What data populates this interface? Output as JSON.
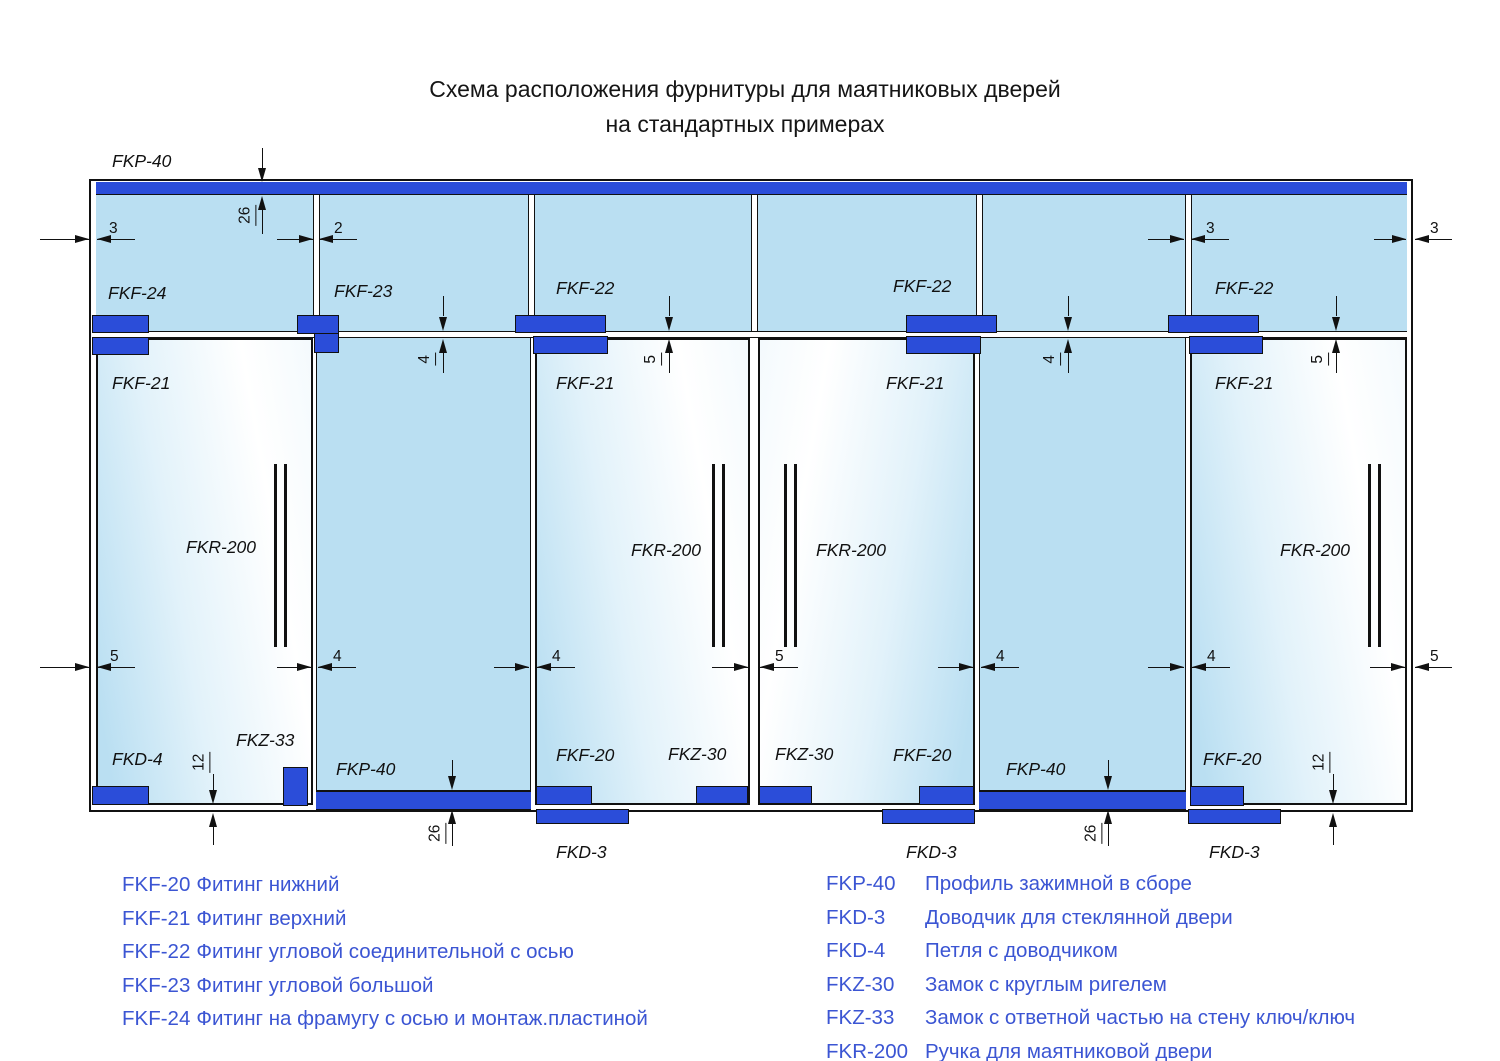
{
  "title": {
    "line1": "Схема расположения фурнитуры для маятниковых дверей",
    "line2": "на стандартных примерах"
  },
  "labels": {
    "fkp40": "FKP-40",
    "fkf24": "FKF-24",
    "fkf23": "FKF-23",
    "fkf22": "FKF-22",
    "fkf21": "FKF-21",
    "fkf20": "FKF-20",
    "fkr200": "FKR-200",
    "fkd4": "FKD-4",
    "fkd3": "FKD-3",
    "fkz33": "FKZ-33",
    "fkz30": "FKZ-30"
  },
  "dims": {
    "d2": "2",
    "d3": "3",
    "d4": "4",
    "d5": "5",
    "d12": "12",
    "d26": "26"
  },
  "legend": {
    "left": [
      {
        "code": "FKF-20",
        "desc": "Фитинг нижний"
      },
      {
        "code": "FKF-21",
        "desc": "Фитинг верхний"
      },
      {
        "code": "FKF-22",
        "desc": "Фитинг угловой соединительной с осью"
      },
      {
        "code": "FKF-23",
        "desc": "Фитинг угловой большой"
      },
      {
        "code": "FKF-24",
        "desc": "Фитинг на фрамугу с осью и монтаж.пластиной"
      }
    ],
    "right": [
      {
        "code": "FKP-40",
        "desc": "Профиль зажимной в сборе"
      },
      {
        "code": "FKD-3",
        "desc": "Доводчик для стеклянной двери"
      },
      {
        "code": "FKD-4",
        "desc": "Петля с доводчиком"
      },
      {
        "code": "FKZ-30",
        "desc": "Замок с круглым ригелем"
      },
      {
        "code": "FKZ-33",
        "desc": "Замок с ответной частью на стену ключ/ключ"
      },
      {
        "code": "FKR-200",
        "desc": "Ручка для маятниковой двери"
      }
    ]
  },
  "colors": {
    "fitting_blue": "#2b4dd9",
    "glass_blue": "#badff2",
    "legend_blue": "#3b55d3"
  }
}
